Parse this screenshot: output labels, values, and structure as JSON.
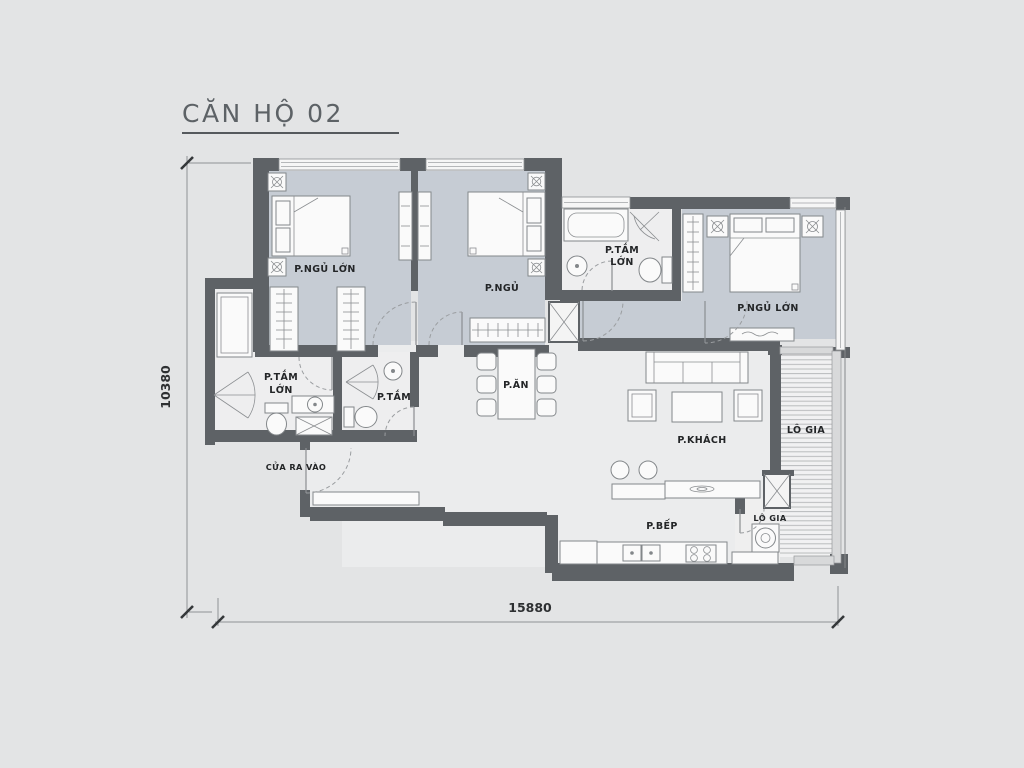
{
  "title": "CĂN HỘ 02",
  "dimensions": {
    "width": "15880",
    "height": "10380"
  },
  "labels": {
    "bedroom1": "P.NGỦ LỚN",
    "bedroom2": "P.NGỦ",
    "bedroom3": "P.NGỦ LỚN",
    "bath_top_line1": "P.TẮM",
    "bath_top_line2": "LỚN",
    "bath_master_line1": "P.TẮM",
    "bath_master_line2": "LỚN",
    "bath_small": "P.TẮM",
    "dining": "P.ĂN",
    "living": "P.KHÁCH",
    "kitchen": "P.BẾP",
    "loggia_main": "LÔ GIA",
    "loggia_small": "LÔ GIA",
    "entrance": "CỬA RA VÀO"
  },
  "colors": {
    "background": "#e3e4e5",
    "wall": "#5e6266",
    "bedroom_floor": "#c6ccd4",
    "floor": "#ebeced",
    "bath_floor": "#eeeeef",
    "furniture_stroke": "#83878a",
    "label_text": "#232527",
    "title_text": "#5d6266"
  }
}
